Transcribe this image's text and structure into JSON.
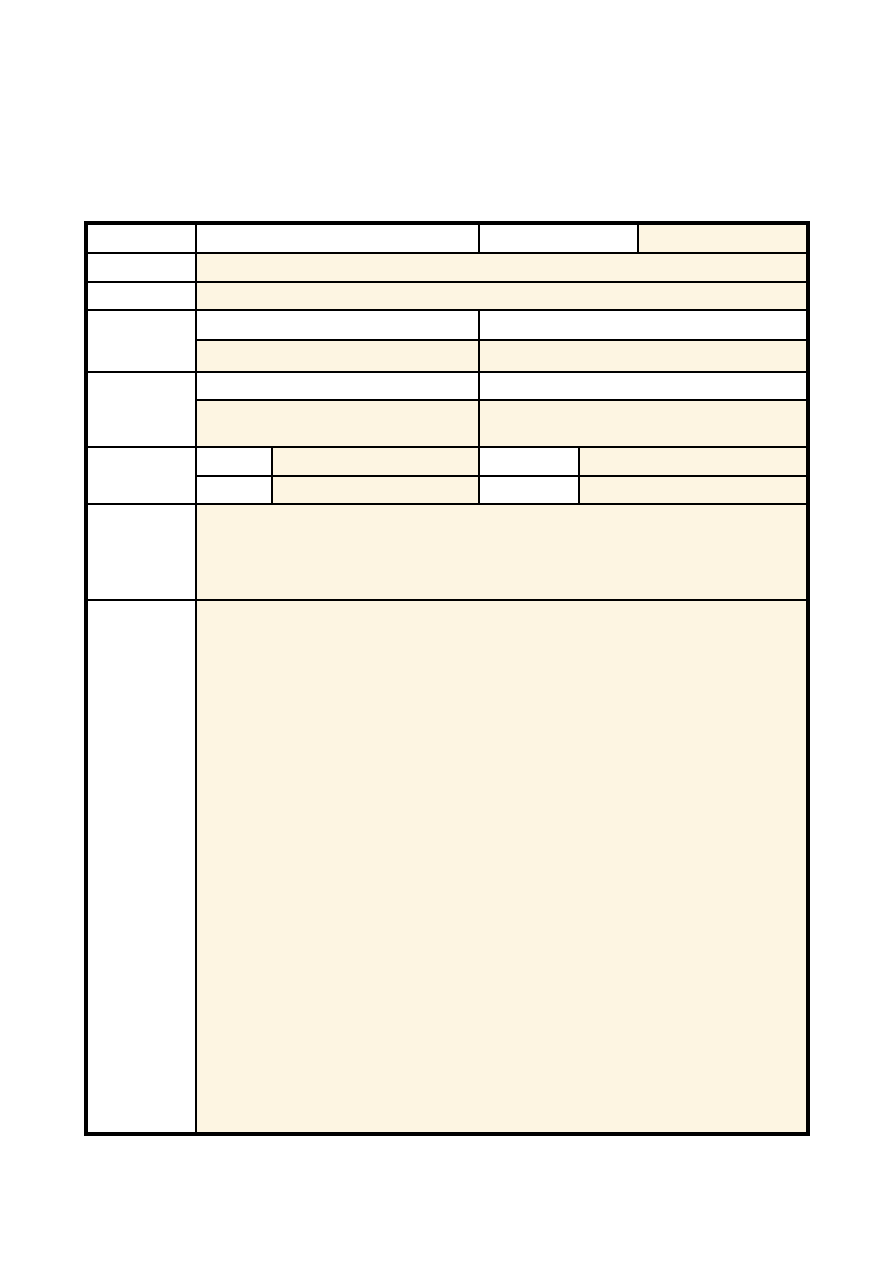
{
  "colors": {
    "page-bg": "#FFFFFF",
    "border": "#000000",
    "field-fill": "#FDF5E2",
    "field-empty": "#FFFFFF"
  },
  "form": {
    "rows": [
      {
        "name": "row-1",
        "label": "",
        "fields": [
          "",
          "",
          ""
        ]
      },
      {
        "name": "row-2",
        "label": "",
        "fields": [
          ""
        ]
      },
      {
        "name": "row-3",
        "label": "",
        "fields": [
          ""
        ]
      },
      {
        "name": "row-4",
        "label": "",
        "fields": [
          "",
          "",
          "",
          ""
        ]
      },
      {
        "name": "row-5",
        "label": "",
        "fields": [
          "",
          "",
          "",
          ""
        ]
      },
      {
        "name": "row-6",
        "label": "",
        "fields": [
          "",
          "",
          "",
          "",
          "",
          "",
          "",
          ""
        ]
      },
      {
        "name": "row-7",
        "label": "",
        "fields": [
          ""
        ]
      },
      {
        "name": "row-8",
        "label": "",
        "fields": [
          ""
        ]
      }
    ]
  }
}
